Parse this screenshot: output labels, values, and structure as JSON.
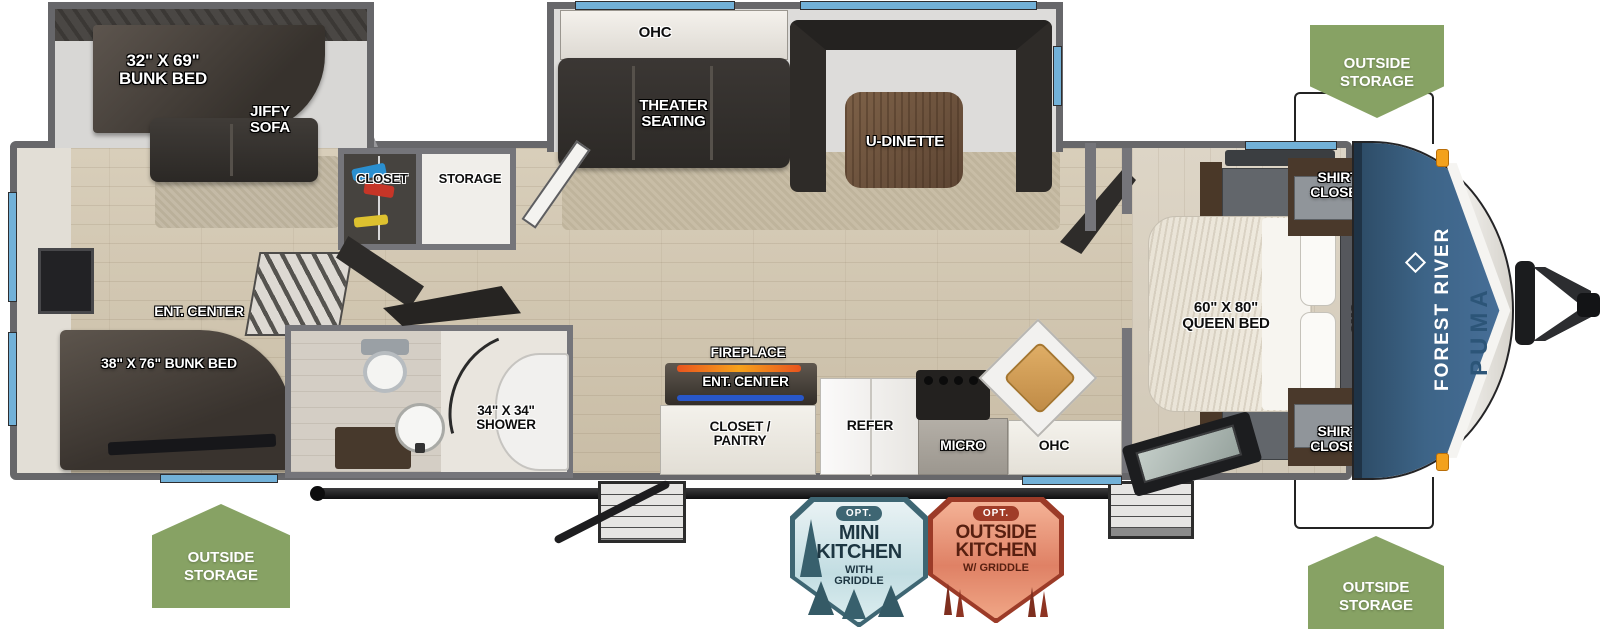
{
  "title": "Forest River Puma travel trailer floorplan",
  "brand": {
    "manufacturer": "FOREST RIVER",
    "model": "PUMA"
  },
  "labels": {
    "bunk_slide_bed": "32\" X 69\"\nBUNK BED",
    "jiffy_sofa": "JIFFY\nSOFA",
    "ohc": "OHC",
    "theater_seating": "THEATER\nSEATING",
    "u_dinette": "U-DINETTE",
    "closet": "CLOSET",
    "storage": "STORAGE",
    "rear_ent_center": "ENT. CENTER",
    "rear_bunk_bed": "38\" X 76\" BUNK BED",
    "shower": "34\" X 34\"\nSHOWER",
    "fireplace": "FIREPLACE",
    "kitchen_ent_center": "ENT. CENTER",
    "closet_pantry": "CLOSET /\nPANTRY",
    "refer": "REFER",
    "micro": "MICRO",
    "kitchen_ohc": "OHC",
    "queen_bed": "60\" X 80\"\nQUEEN BED",
    "shirt_closet": "SHIRT\nCLOSET",
    "bedroom_ohc": "OHC"
  },
  "badges": {
    "outside_storage": "OUTSIDE\nSTORAGE",
    "mini_kitchen": {
      "opt": "OPT.",
      "title": "MINI\nKITCHEN",
      "subtitle": "WITH\nGRIDDLE"
    },
    "outside_kitchen": {
      "opt": "OPT.",
      "title": "OUTSIDE\nKITCHEN",
      "subtitle": "W/ GRIDDLE"
    }
  },
  "colors": {
    "wall": "#67676a",
    "floor": "#d2c7b2",
    "slide_floor": "#dbdad8",
    "cap_blue": "#3d6487",
    "window": "#72b1d8",
    "badge_green": "#87a264",
    "mini_badge_border": "#3e6673",
    "outside_badge_border": "#9c3b28",
    "fireplace_accent": "#f07a1e",
    "led_accent": "#2857c9",
    "furniture_dark": "#35322e"
  }
}
